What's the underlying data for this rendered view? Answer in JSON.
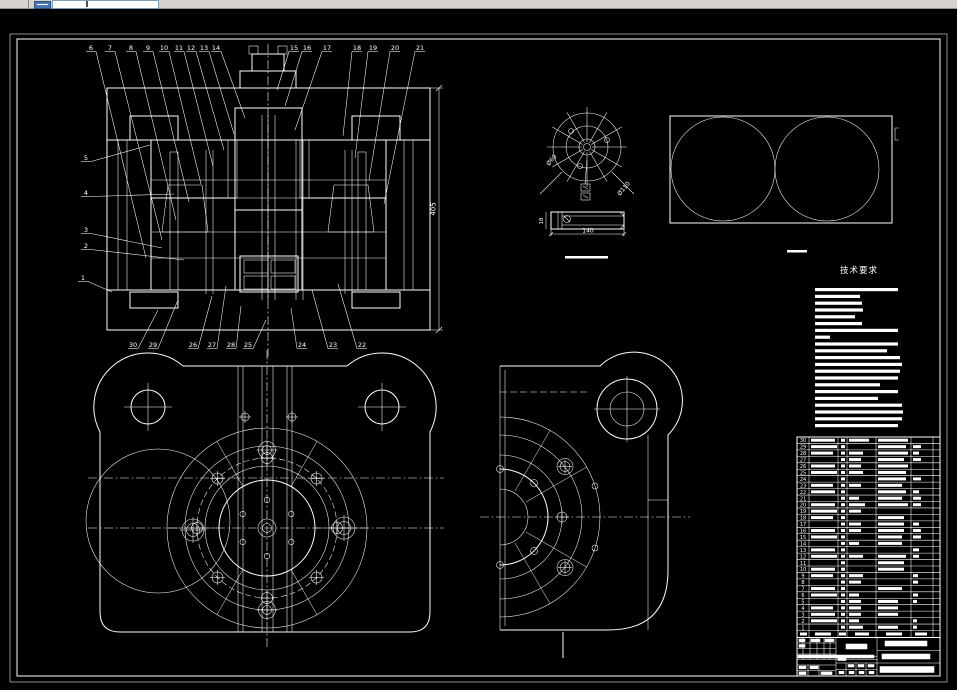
{
  "window": {
    "toolbar": {
      "icon": "table-grid-icon",
      "combo_value": ""
    }
  },
  "tech_requirements": {
    "title": "技术要求",
    "line_widths": [
      83,
      45,
      47,
      48,
      40,
      47,
      83,
      15,
      83,
      72,
      85,
      87,
      85,
      83,
      65,
      83,
      63,
      87,
      88,
      87,
      83
    ]
  },
  "dimensions": {
    "overall_height": "405",
    "detail_length": "140",
    "detail_height": "18",
    "detail_dia_inner": "Ø60",
    "detail_dia_outer": "Ø110"
  },
  "callouts": {
    "top": [
      [
        "6",
        91,
        146,
        250
      ],
      [
        "7",
        110,
        162,
        232
      ],
      [
        "8",
        131,
        176,
        212
      ],
      [
        "9",
        148,
        189,
        194
      ],
      [
        "10",
        164,
        201,
        176
      ],
      [
        "11",
        179,
        213,
        158
      ],
      [
        "12",
        191,
        224,
        142
      ],
      [
        "13",
        204,
        234,
        126
      ],
      [
        "14",
        216,
        245,
        110
      ],
      [
        "15",
        294,
        277,
        82
      ],
      [
        "16",
        307,
        285,
        98
      ],
      [
        "17",
        327,
        295,
        122
      ],
      [
        "18",
        357,
        343,
        128
      ],
      [
        "19",
        373,
        355,
        150
      ],
      [
        "20",
        395,
        369,
        172
      ],
      [
        "21",
        420,
        384,
        196
      ]
    ],
    "left": [
      [
        "5",
        86,
        152,
        150,
        137
      ],
      [
        "4",
        86,
        187,
        174,
        186
      ],
      [
        "3",
        86,
        224,
        162,
        240
      ],
      [
        "2",
        86,
        240,
        184,
        252
      ],
      [
        "1",
        83,
        272,
        112,
        284
      ]
    ],
    "bottom": [
      [
        "30",
        133,
        158,
        302
      ],
      [
        "29",
        153,
        178,
        292
      ],
      [
        "26",
        193,
        212,
        288
      ],
      [
        "27",
        212,
        226,
        278
      ],
      [
        "28",
        231,
        241,
        298
      ],
      [
        "25",
        248,
        266,
        312
      ],
      [
        "24",
        302,
        291,
        300
      ],
      [
        "23",
        333,
        312,
        282
      ],
      [
        "22",
        362,
        338,
        276
      ]
    ]
  },
  "bom": {
    "rows": [
      [
        "30",
        24,
        4,
        20,
        30,
        0
      ],
      [
        "29",
        26,
        4,
        0,
        28,
        8
      ],
      [
        "28",
        22,
        4,
        14,
        30,
        6
      ],
      [
        "27",
        0,
        4,
        12,
        26,
        8
      ],
      [
        "26",
        24,
        4,
        12,
        30,
        0
      ],
      [
        "25",
        26,
        4,
        14,
        28,
        0
      ],
      [
        "24",
        0,
        4,
        0,
        28,
        8
      ],
      [
        "23",
        22,
        4,
        12,
        24,
        0
      ],
      [
        "22",
        24,
        4,
        0,
        28,
        6
      ],
      [
        "21",
        0,
        4,
        10,
        24,
        8
      ],
      [
        "20",
        24,
        4,
        16,
        30,
        8
      ],
      [
        "19",
        26,
        4,
        12,
        0,
        0
      ],
      [
        "18",
        22,
        4,
        0,
        26,
        0
      ],
      [
        "17",
        0,
        4,
        12,
        26,
        6
      ],
      [
        "16",
        24,
        4,
        12,
        26,
        8
      ],
      [
        "15",
        26,
        4,
        0,
        24,
        8
      ],
      [
        "14",
        0,
        4,
        10,
        24,
        0
      ],
      [
        "13",
        24,
        4,
        0,
        0,
        6
      ],
      [
        "12",
        26,
        4,
        14,
        28,
        6
      ],
      [
        "11",
        0,
        4,
        0,
        26,
        0
      ],
      [
        "10",
        24,
        4,
        0,
        26,
        0
      ],
      [
        "9",
        22,
        4,
        14,
        0,
        5
      ],
      [
        "8",
        0,
        4,
        12,
        0,
        5
      ],
      [
        "7",
        24,
        4,
        0,
        24,
        0
      ],
      [
        "6",
        26,
        4,
        10,
        0,
        5
      ],
      [
        "5",
        0,
        4,
        12,
        20,
        4
      ],
      [
        "4",
        22,
        4,
        12,
        20,
        0
      ],
      [
        "3",
        24,
        4,
        12,
        20,
        0
      ],
      [
        "2",
        26,
        4,
        10,
        0,
        4
      ],
      [
        "1",
        0,
        4,
        14,
        20,
        4
      ]
    ]
  }
}
